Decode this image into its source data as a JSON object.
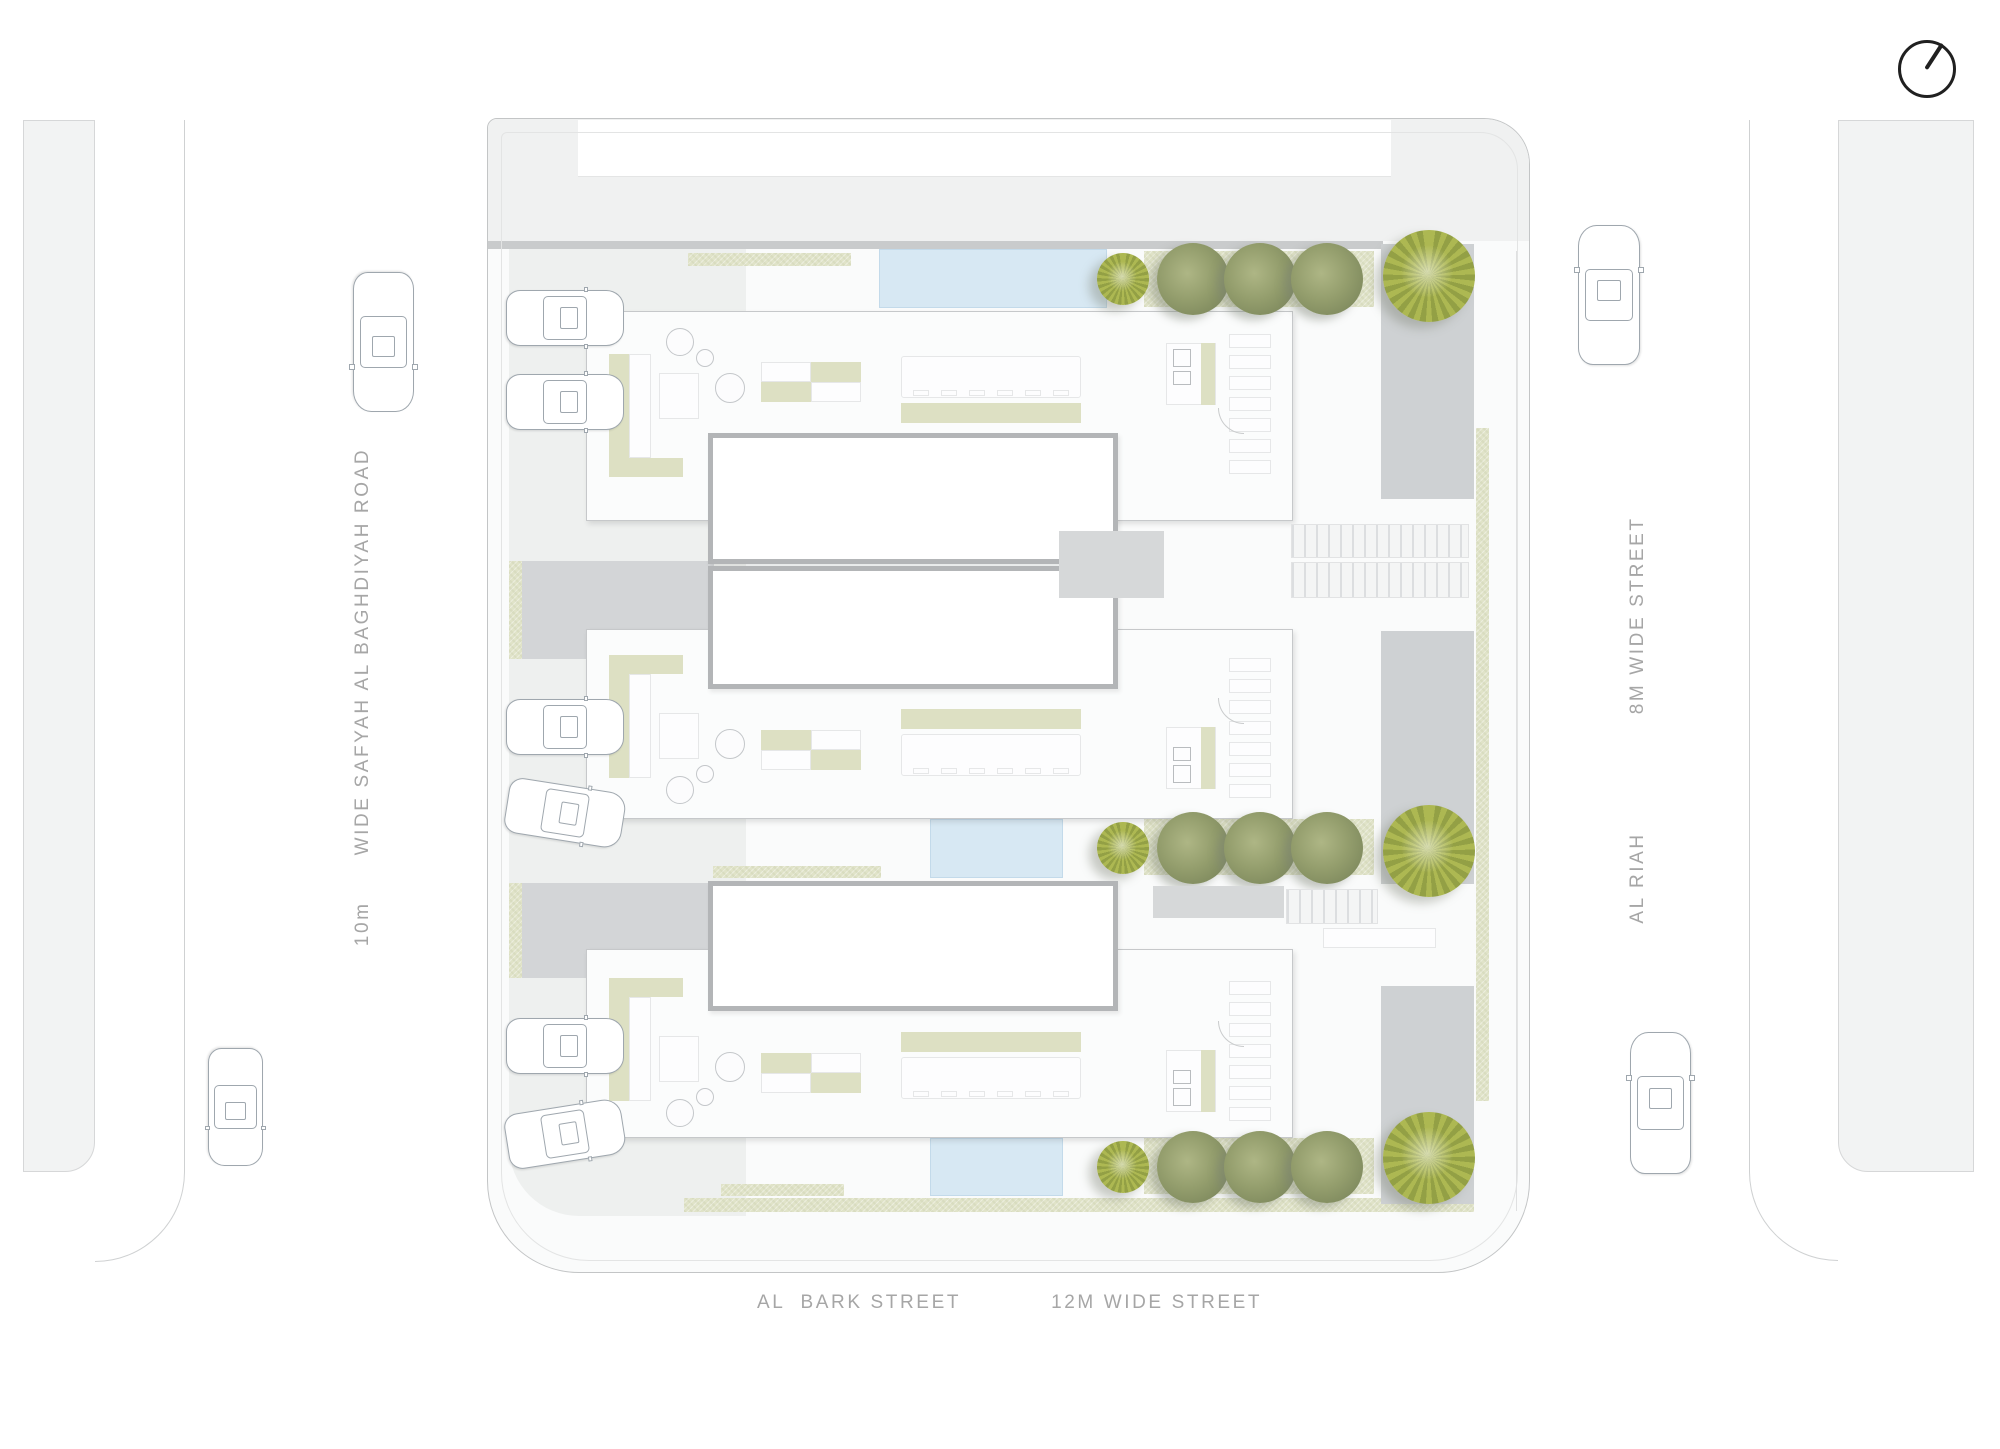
{
  "north_arrow": {
    "icon": "north-arrow-icon"
  },
  "roads": {
    "left": {
      "width_label": "10m",
      "name_label": "WIDE SAFYAH AL BAGHDIYAH ROAD"
    },
    "right": {
      "name_label": "AL RIAH",
      "width_label": "8M WIDE STREET"
    },
    "bottom": {
      "name_label": "AL  BARK STREET",
      "width_label": "12M WIDE STREET"
    }
  },
  "site": {
    "villas": [
      {
        "id": "villa-1",
        "yard_side": "north",
        "garage_cars": 2,
        "hedge_trees": 3,
        "large_trees": 1,
        "small_trees": 1,
        "pool": true
      },
      {
        "id": "villa-2",
        "yard_side": "south",
        "garage_cars": 2,
        "hedge_trees": 3,
        "large_trees": 1,
        "small_trees": 1,
        "pool": true
      },
      {
        "id": "villa-3",
        "yard_side": "south",
        "garage_cars": 2,
        "hedge_trees": 3,
        "large_trees": 1,
        "small_trees": 1,
        "pool": true
      }
    ],
    "street_cars": [
      {
        "road": "left",
        "heading": "south"
      },
      {
        "road": "left",
        "heading": "south"
      },
      {
        "road": "right",
        "heading": "north"
      },
      {
        "road": "right",
        "heading": "north"
      }
    ]
  },
  "colors": {
    "paper": "#ffffff",
    "road_strip": "#f2f3f3",
    "plot_fill": "#fafbfb",
    "court_gray": "#eef0ef",
    "wall_gray": "#d3d5d7",
    "driveway_gray": "#ced1d3",
    "planting_green": "#e0e3c8",
    "tree_green": "#949e6d",
    "tree_yellow_green": "#a3ae4d",
    "pool_blue": "#d7e8f3",
    "label_gray": "#a6a6a6",
    "line_gray": "#c6c8ca"
  }
}
